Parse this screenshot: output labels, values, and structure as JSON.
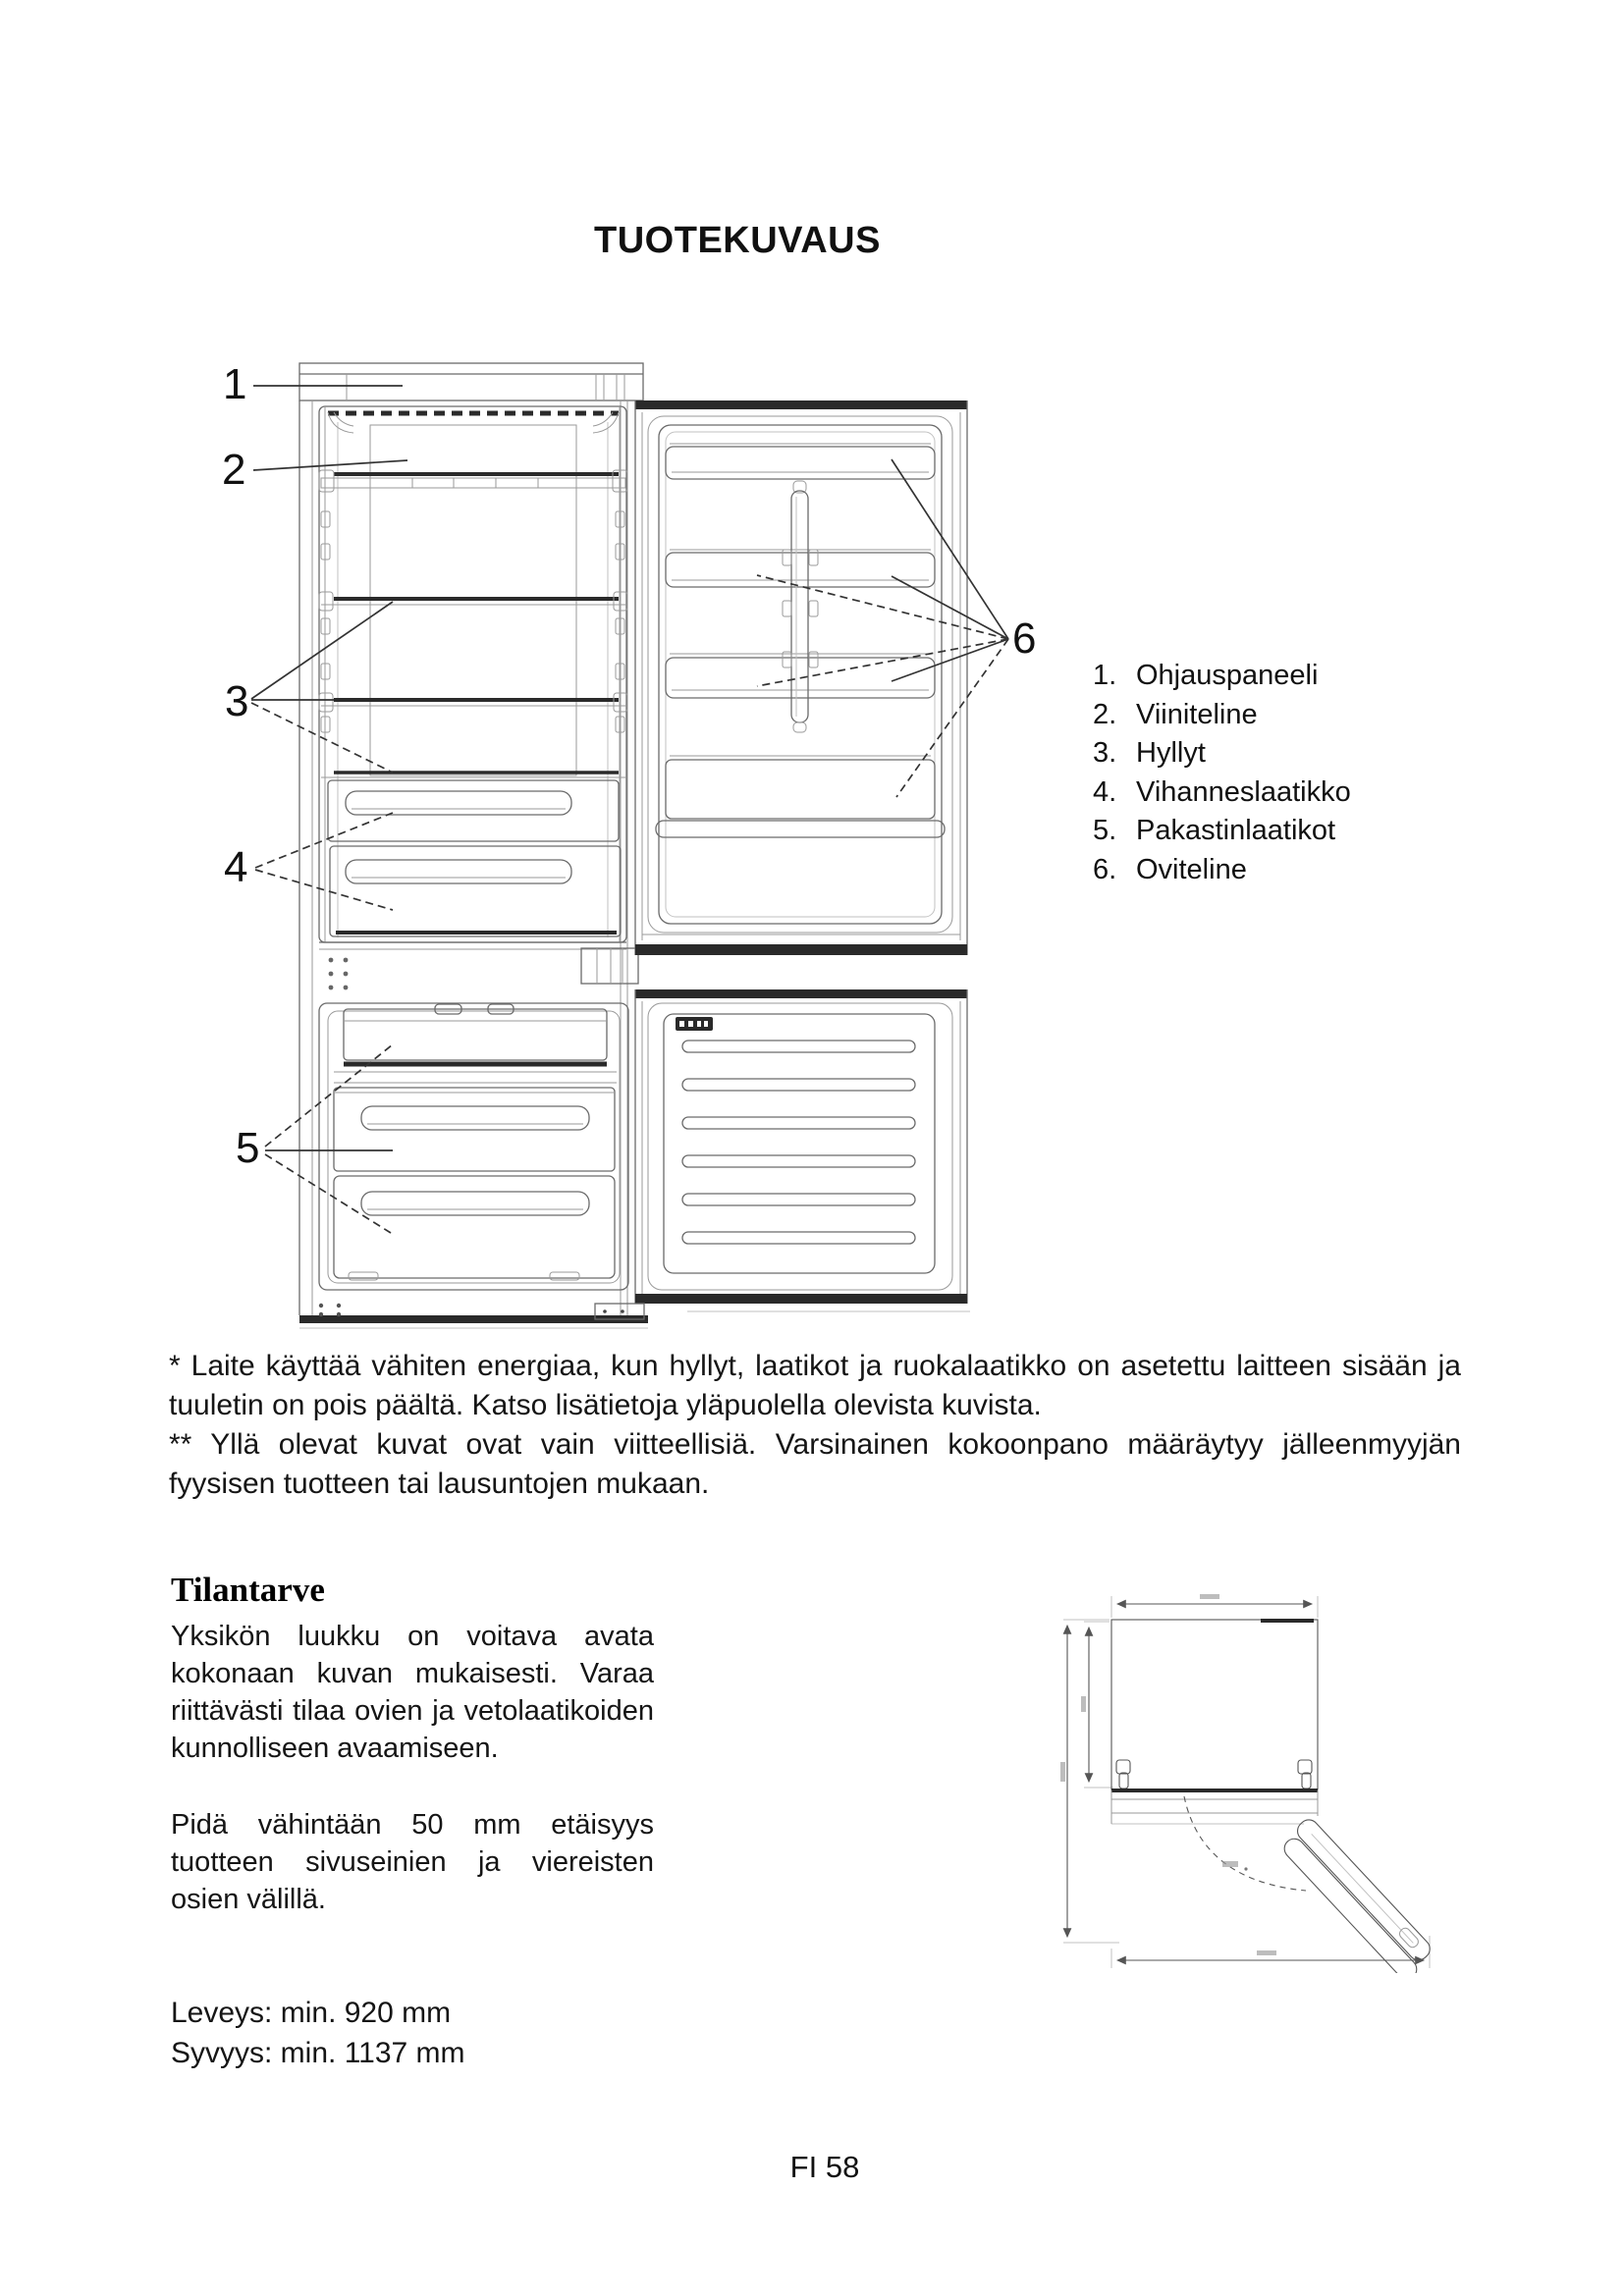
{
  "page": {
    "title": "TUOTEKUVAUS",
    "page_label": "FI 58"
  },
  "figure": {
    "callouts": [
      "1",
      "2",
      "3",
      "4",
      "5",
      "6"
    ]
  },
  "legend": {
    "items": [
      {
        "num": "1.",
        "label": "Ohjauspaneeli"
      },
      {
        "num": "2.",
        "label": "Viiniteline"
      },
      {
        "num": "3.",
        "label": "Hyllyt"
      },
      {
        "num": "4.",
        "label": "Vihanneslaatikko"
      },
      {
        "num": "5.",
        "label": "Pakastinlaatikot"
      },
      {
        "num": "6.",
        "label": "Oviteline"
      }
    ]
  },
  "notes": {
    "para1": "* Laite käyttää vähiten energiaa, kun hyllyt, laatikot ja ruokalaatikko on asetettu laitteen sisään ja tuuletin on pois päältä. Katso lisätietoja yläpuolella olevista kuvista.",
    "para2": "** Yllä olevat kuvat ovat vain viitteellisiä. Varsinainen kokoonpano määräytyy jälleenmyyjän fyysisen tuotteen tai lausuntojen mukaan."
  },
  "clearance": {
    "heading": "Tilantarve",
    "para1": "Yksikön luukku on voitava avata kokonaan kuvan mukaisesti. Varaa riittävästi tilaa ovien ja vetolaatikoiden kunnolliseen avaamiseen.",
    "para2": "Pidä vähintään 50 mm etäisyys tuotteen sivuseinien ja viereisten osien välillä.",
    "width_line": "Leveys: min. 920 mm",
    "depth_line": "Syvyys: min. 1137 mm"
  }
}
